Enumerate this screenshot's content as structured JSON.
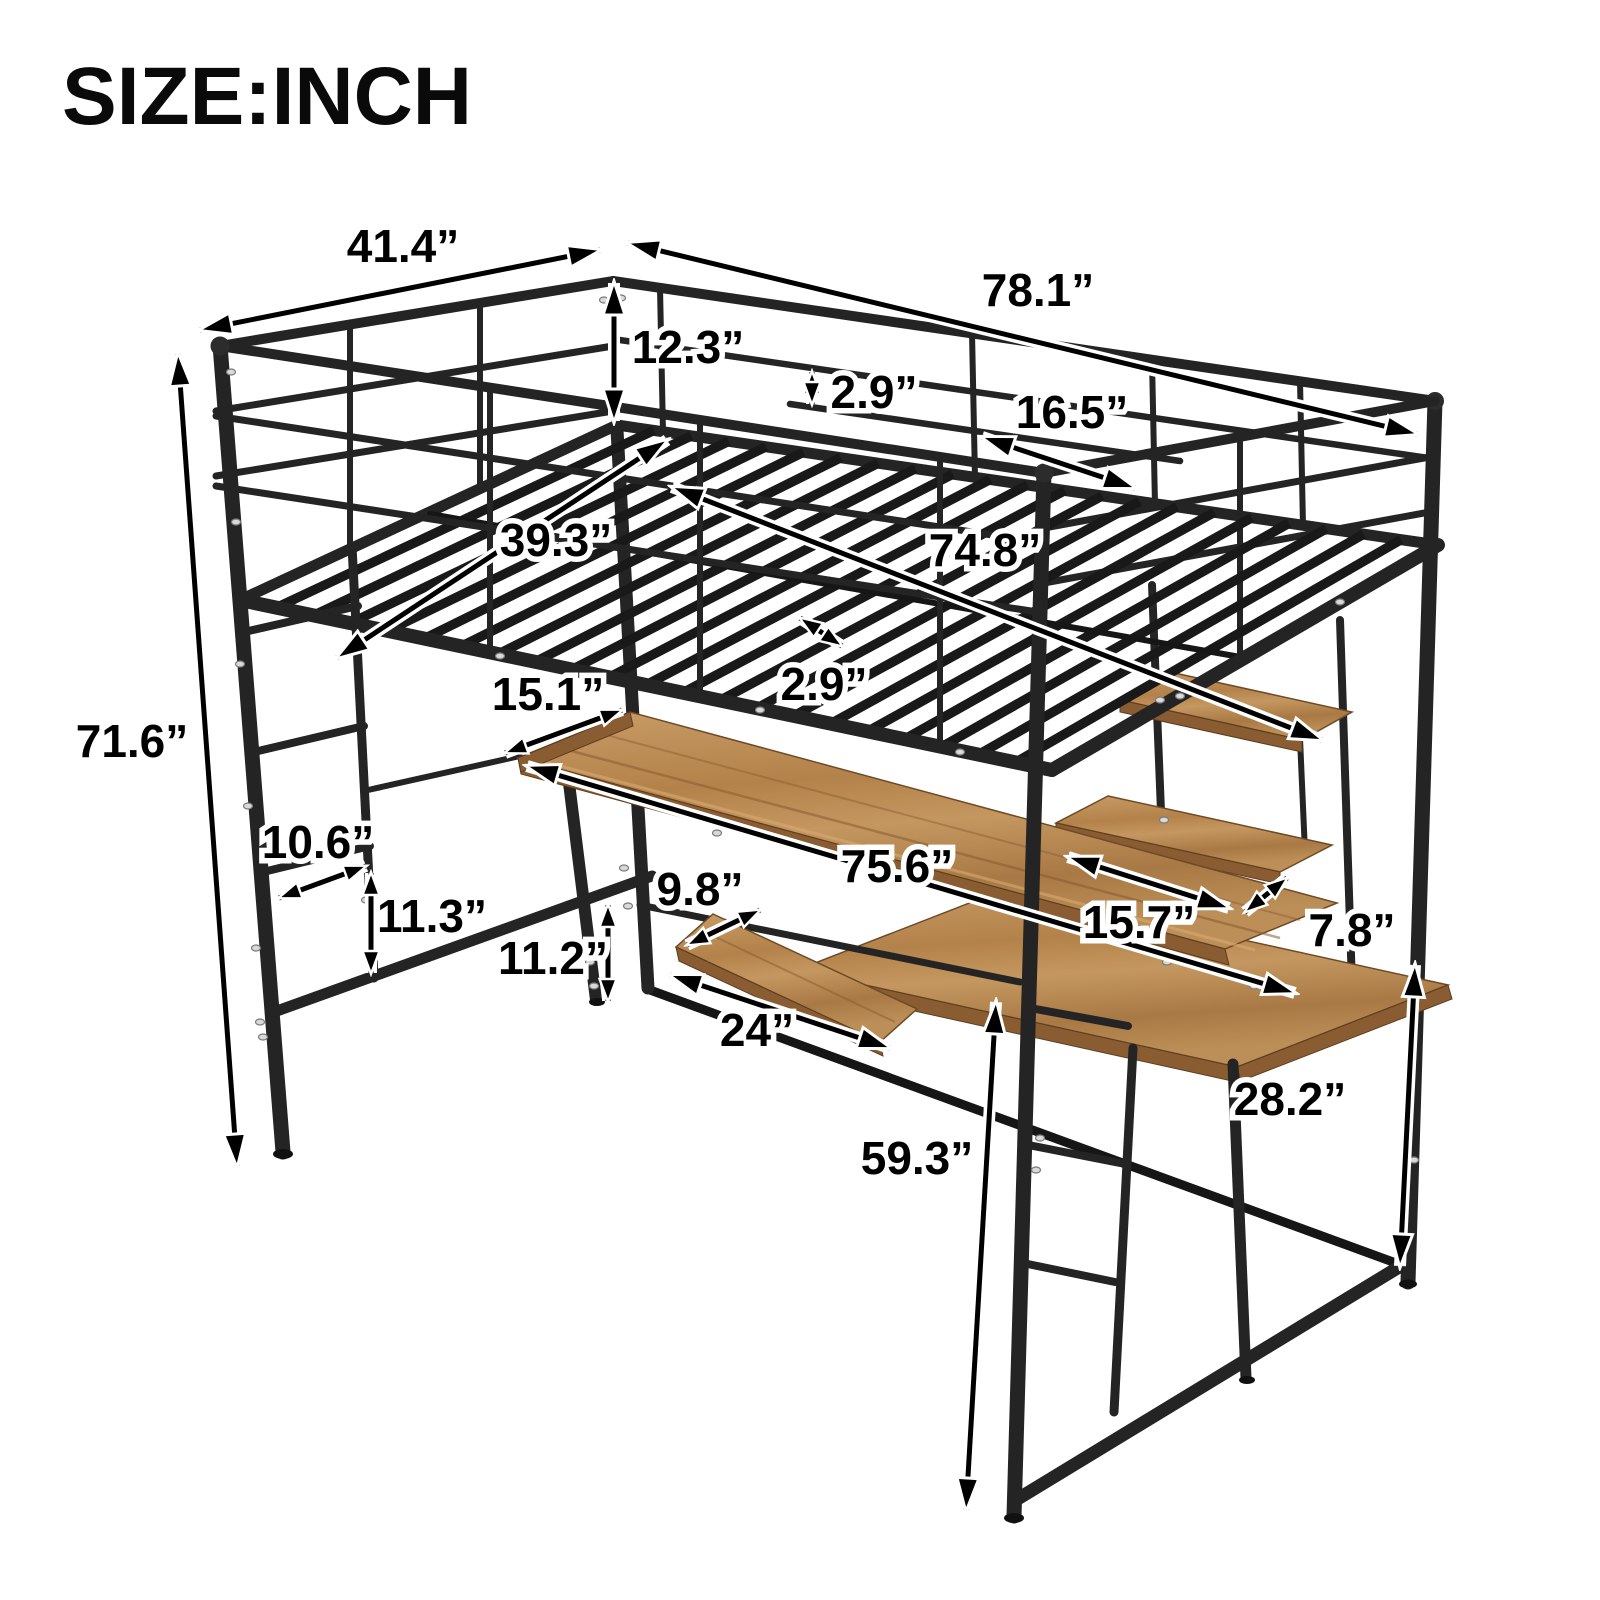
{
  "title": {
    "text": "SIZE:INCH"
  },
  "page": {
    "background": "#ffffff",
    "unit": "inch"
  },
  "colors": {
    "metal": "#242424",
    "wood": "#b9874f",
    "wood_edge": "#8a5c32",
    "dimension_line": "#000000",
    "label_fill": "#000000",
    "label_outline": "#ffffff"
  },
  "dimensions": [
    {
      "id": "top-side-width",
      "label": "41.4”"
    },
    {
      "id": "top-length",
      "label": "78.1”"
    },
    {
      "id": "guardrail-height",
      "label": "12.3”"
    },
    {
      "id": "guardrail-bar-gap",
      "label": "2.9”"
    },
    {
      "id": "guardrail-section",
      "label": "16.5”"
    },
    {
      "id": "sleep-surface-length",
      "label": "74.8”"
    },
    {
      "id": "sleep-surface-width",
      "label": "39.3”"
    },
    {
      "id": "slat-gap",
      "label": "2.9”"
    },
    {
      "id": "overall-height",
      "label": "71.6”"
    },
    {
      "id": "desk-depth",
      "label": "15.1”"
    },
    {
      "id": "desk-length",
      "label": "75.6”"
    },
    {
      "id": "tray-depth",
      "label": "9.8”"
    },
    {
      "id": "tray-length",
      "label": "24”"
    },
    {
      "id": "ladder-width",
      "label": "10.6”"
    },
    {
      "id": "ladder-rung-spacing",
      "label": "11.3”"
    },
    {
      "id": "bottom-rail-height",
      "label": "11.2”"
    },
    {
      "id": "shelf-length",
      "label": "15.7”"
    },
    {
      "id": "shelf-depth",
      "label": "7.8”"
    },
    {
      "id": "side-desk-height",
      "label": "28.2”"
    },
    {
      "id": "under-bed-clearance",
      "label": "59.3”"
    }
  ]
}
